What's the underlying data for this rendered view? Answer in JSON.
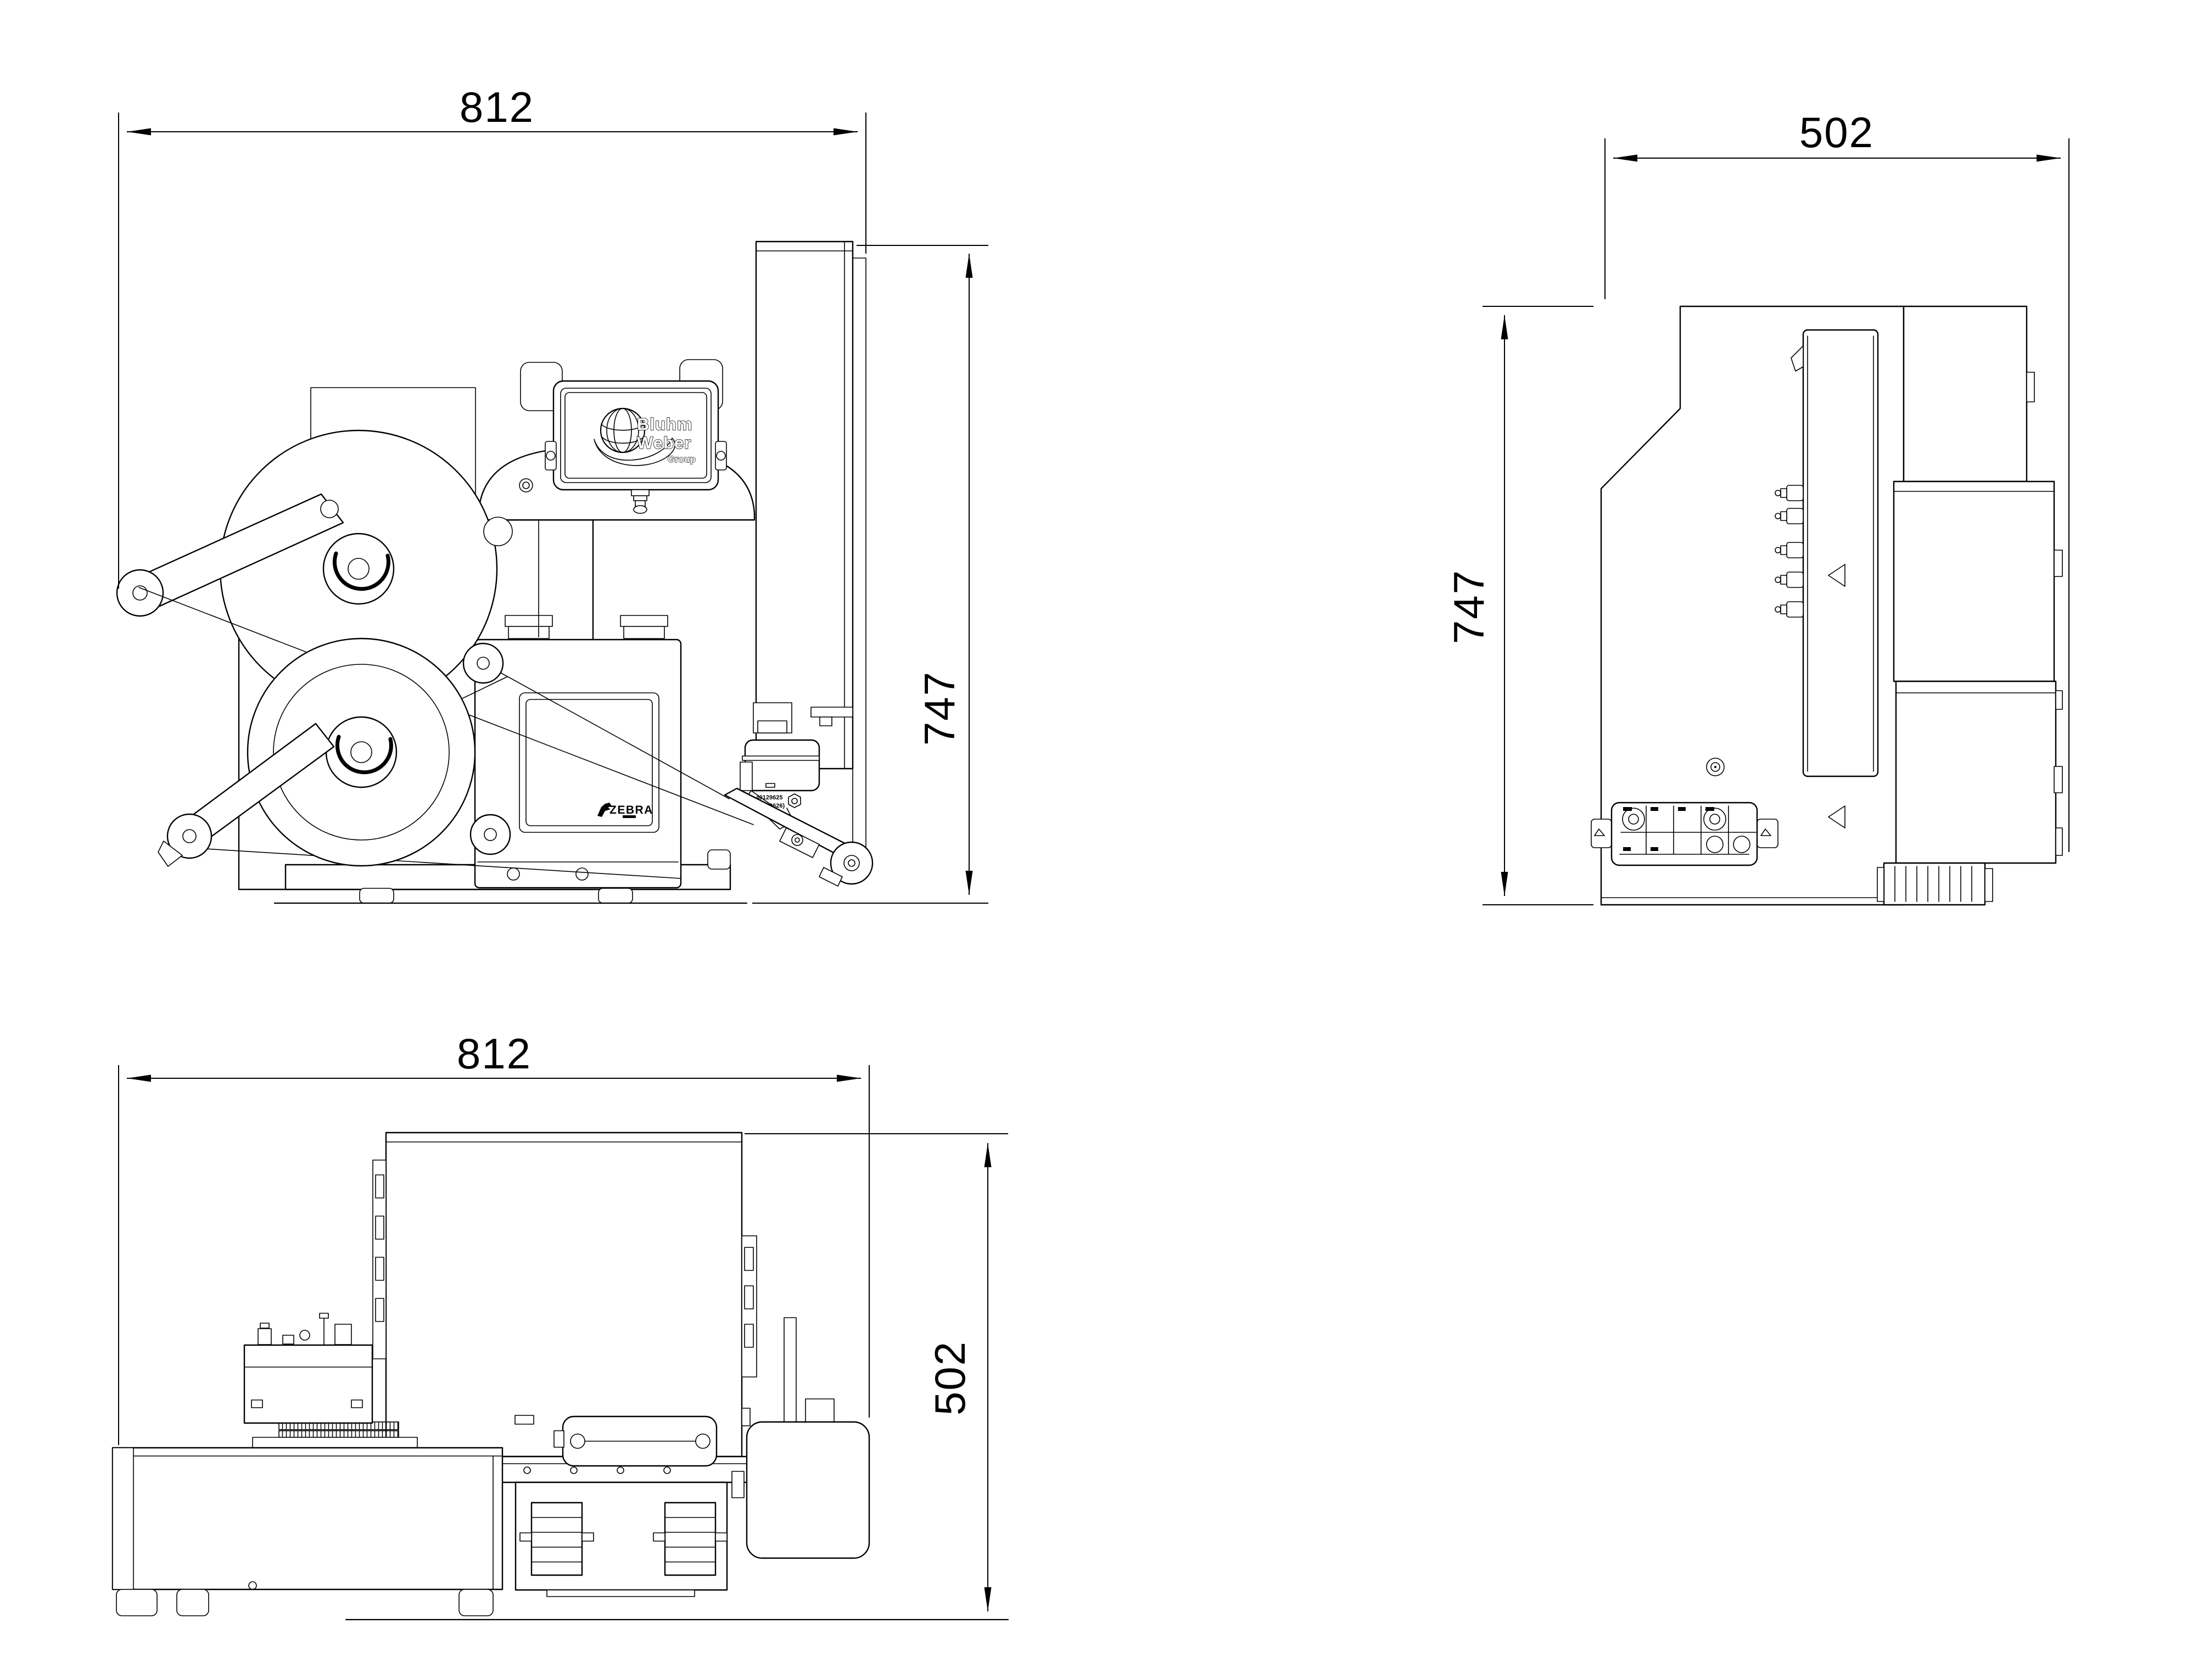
{
  "drawing": {
    "background_color": "#ffffff",
    "line_color": "#000000",
    "views": {
      "front": {
        "name": "front-view",
        "width_dim": "812",
        "height_dim": "747"
      },
      "side": {
        "name": "side-view",
        "width_dim": "502",
        "height_dim": "747"
      },
      "top": {
        "name": "top-view",
        "width_dim": "812",
        "height_dim": "502"
      }
    },
    "hmi_logo": {
      "line1": "Bluhm",
      "line2": "Weber",
      "line3": "Group"
    },
    "printer_brand": "ZEBRA",
    "applicator_part_label": {
      "line1": "40129625",
      "line2": "(40129626)"
    },
    "icons": {
      "hmi_logo_globe": "globe-with-swoosh",
      "printer_logo_mark": "zebra-head"
    }
  }
}
